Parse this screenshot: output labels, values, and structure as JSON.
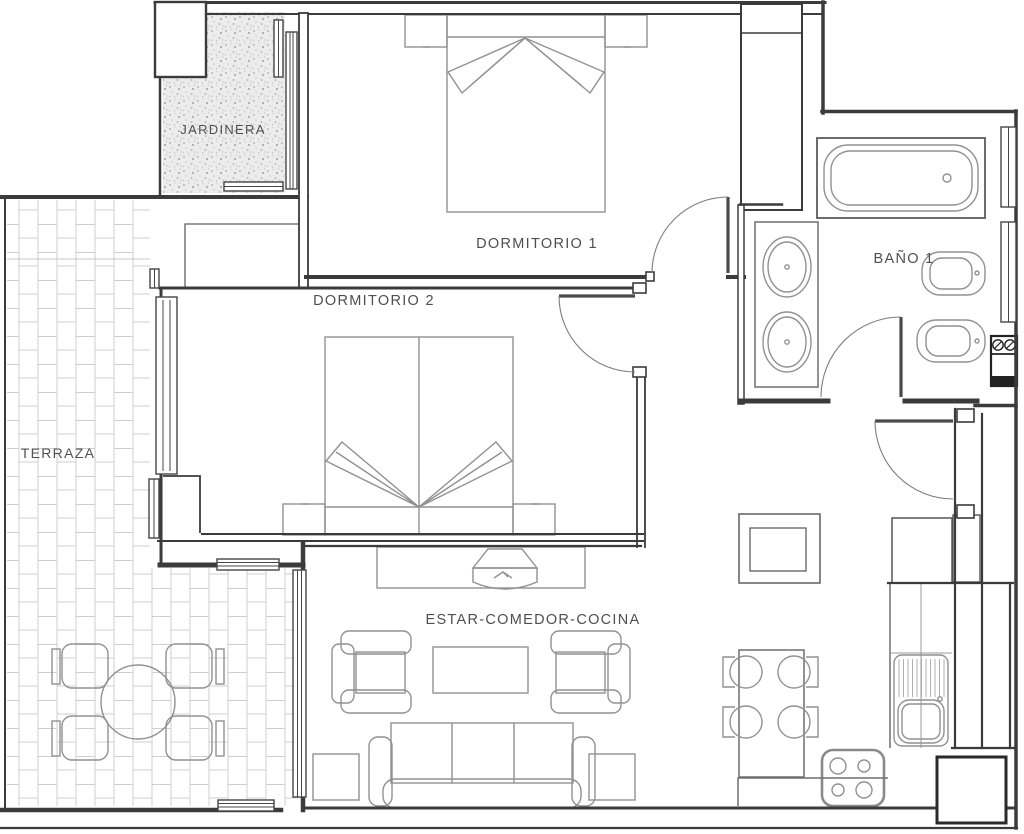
{
  "document": {
    "kind": "architectural-floor-plan",
    "language": "es"
  },
  "colors": {
    "paper": "#ffffff",
    "wall": "#3b3b3b",
    "furniture_line": "#919191",
    "brick_line": "#cfcfcf",
    "label_text": "#4f4f4f"
  },
  "rooms": [
    {
      "id": "jardinera",
      "label": "JARDINERA"
    },
    {
      "id": "dormitorio-1",
      "label": "DORMITORIO 1"
    },
    {
      "id": "dormitorio-2",
      "label": "DORMITORIO 2"
    },
    {
      "id": "terraza",
      "label": "TERRAZA"
    },
    {
      "id": "bano-1",
      "label": "BAÑO 1"
    },
    {
      "id": "estar-comedor-cocina",
      "label": "ESTAR-COMEDOR-COCINA"
    }
  ],
  "symbols": [
    "double-bed-x2",
    "nightstand-x4",
    "wardrobe",
    "bathtub",
    "vanity-two-sinks",
    "toilet",
    "bidet",
    "washing-machine",
    "sofa-3-seat",
    "armchair-x2",
    "coffee-table",
    "tv-on-sideboard",
    "side-table-x2",
    "dining-table-4-chairs",
    "kitchen-sink",
    "stove-4-burners",
    "fridge",
    "terrace-round-table-4-chairs",
    "swing-door-x4",
    "window-strips",
    "brick-paving",
    "gravel-planter"
  ]
}
